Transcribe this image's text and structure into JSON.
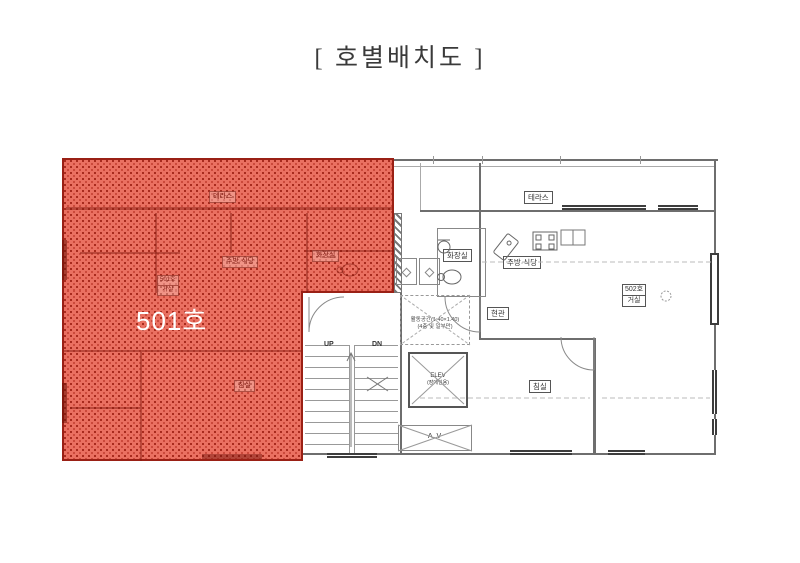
{
  "title": "[ 호별배치도 ]",
  "colors": {
    "highlight_fill": "#ea7061",
    "highlight_dot": "#9e2013",
    "highlight_border": "#9a2015",
    "wall_line": "#6e6e6e",
    "window": "#3d3d3d",
    "unit_number_text": "#ffffff"
  },
  "unit501": {
    "number_label": "501호",
    "rooms": {
      "terrace": "테라스",
      "kitchen_dining": "주방·식당",
      "bathroom": "화장실",
      "bedroom": "침실",
      "living_line1": "501호",
      "living_line2": "거실"
    }
  },
  "core": {
    "stairs_up": "UP",
    "stairs_down": "DN",
    "elevator_line1": "ELEV",
    "elevator_line2": "(장애인용)",
    "air_vent": "A.V",
    "note_line1": "활동공간(1.40×1.40)",
    "note_line2": "(4층 및 일부만)"
  },
  "unit502": {
    "rooms": {
      "terrace": "테라스",
      "bathroom": "화장실",
      "kitchen_dining": "주방·식당",
      "entrance": "현관",
      "living_line1": "502호",
      "living_line2": "거실",
      "bedroom": "침실"
    }
  }
}
